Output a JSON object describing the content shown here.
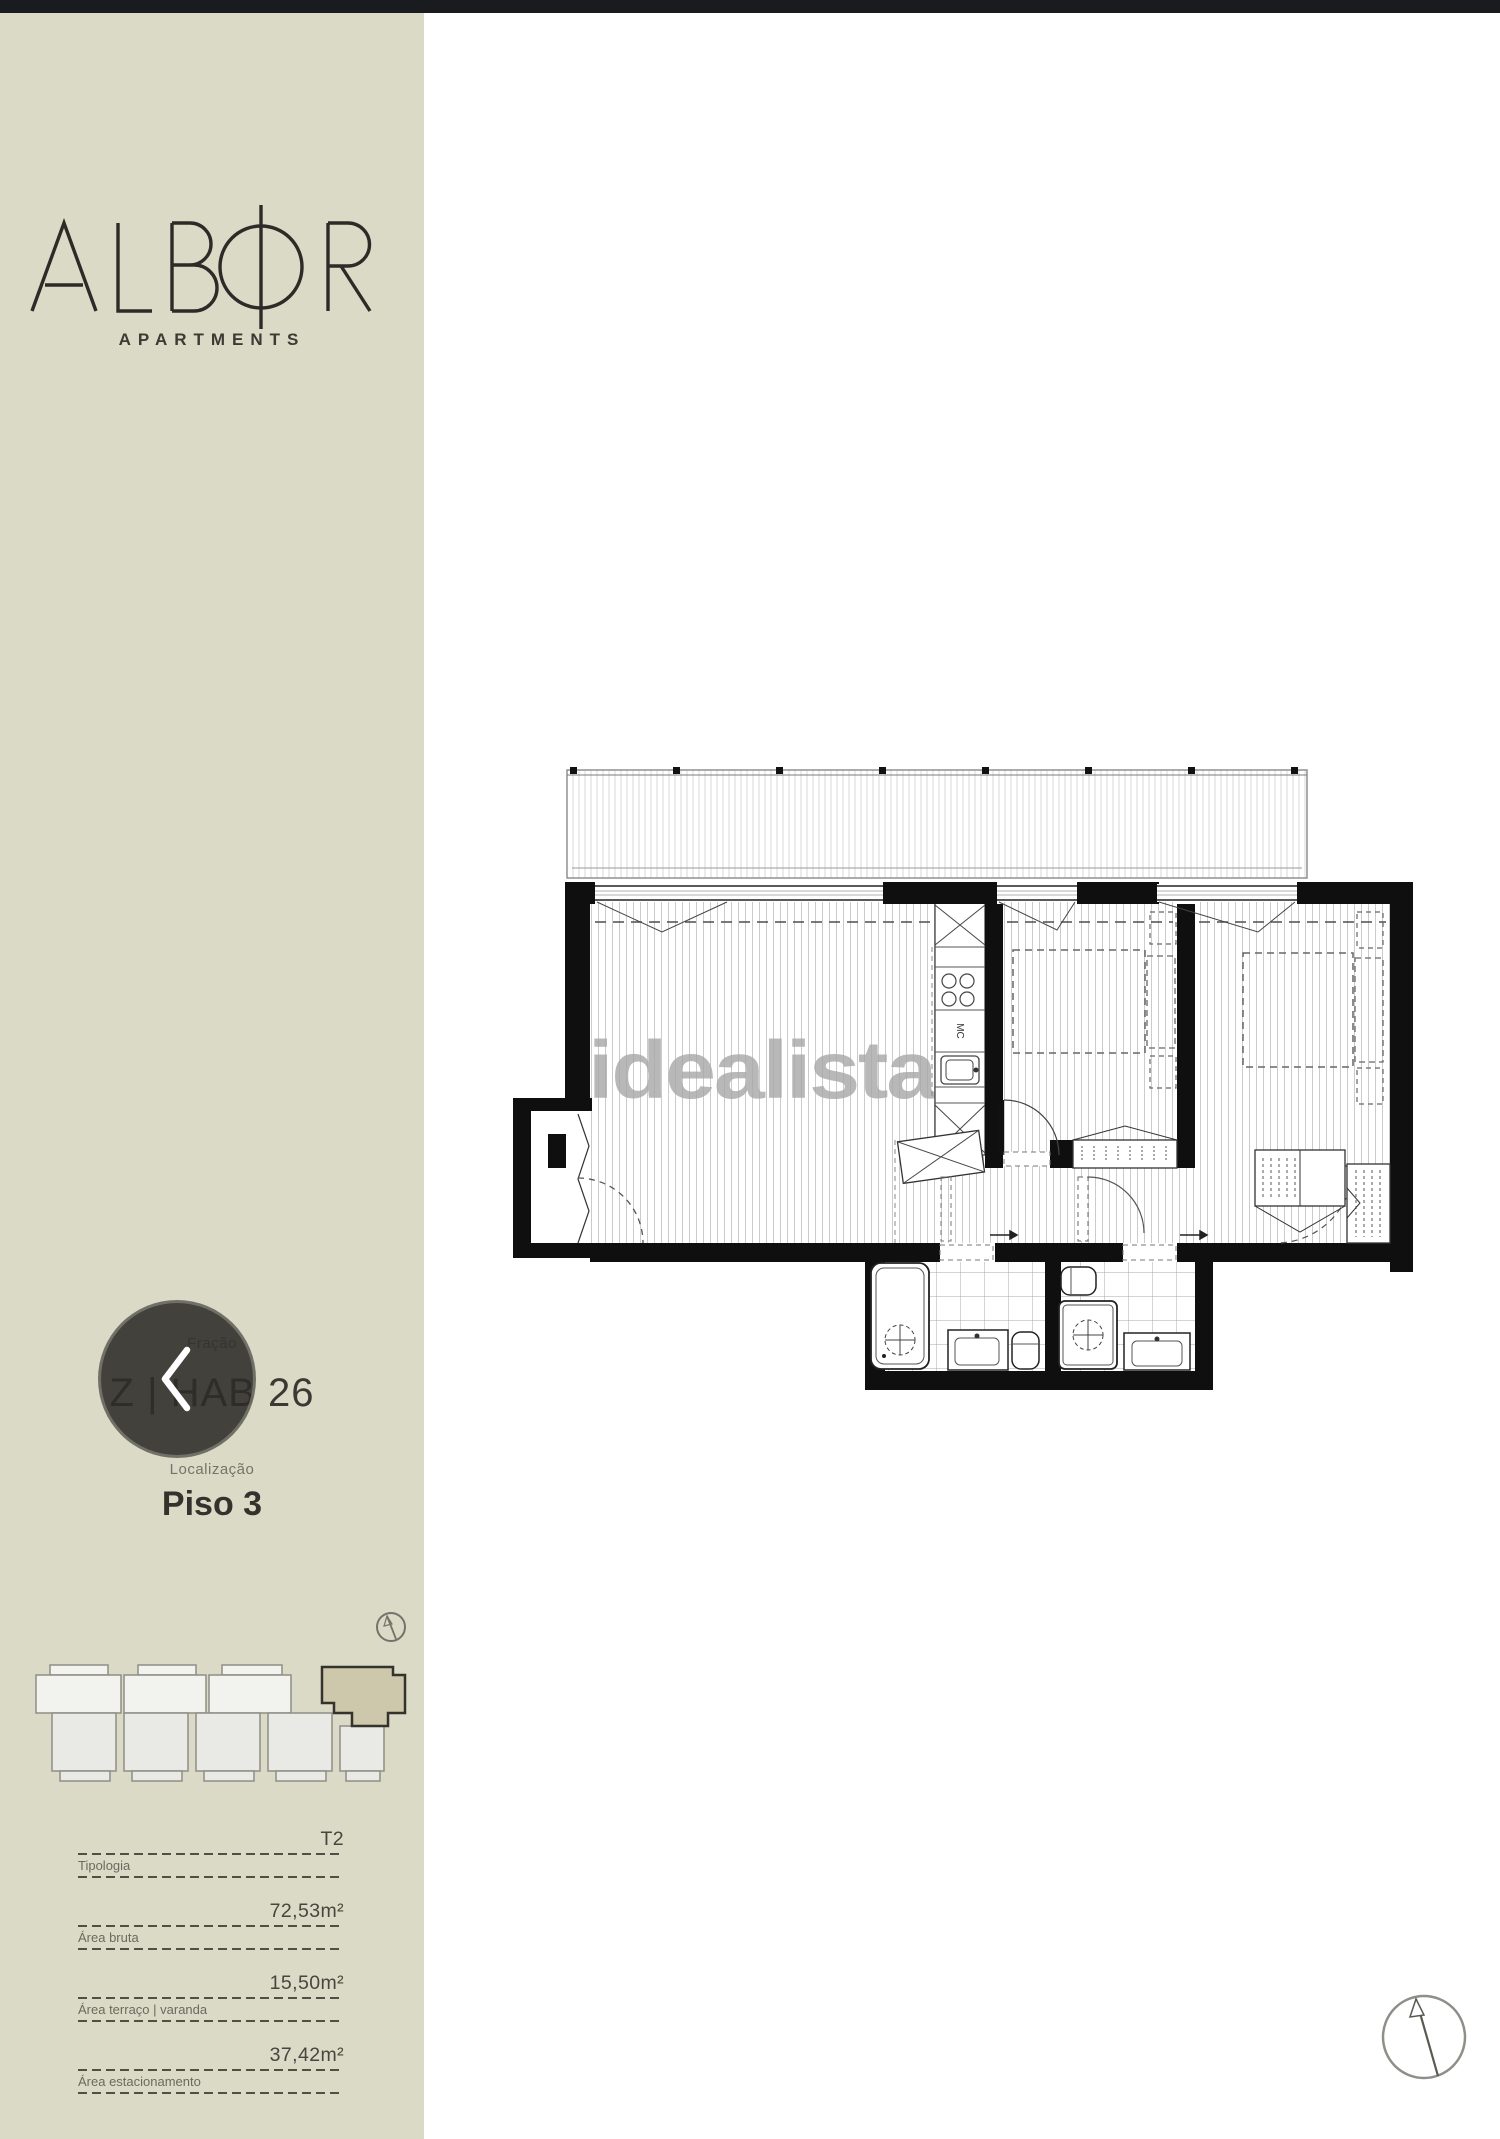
{
  "sidebar": {
    "background": "#dadac6",
    "brand": "ALBOR",
    "brand_subtitle": "APARTMENTS",
    "fraction_label": "Fração",
    "fraction_value": "Z | HAB 26",
    "location_label": "Localização",
    "location_value": "Piso 3",
    "specs": [
      {
        "label": "Tipologia",
        "value": "T2"
      },
      {
        "label": "Área bruta",
        "value": "72,53m²"
      },
      {
        "label": "Área terraço | varanda",
        "value": "15,50m²"
      },
      {
        "label": "Área estacionamento",
        "value": "37,42m²"
      }
    ],
    "highlight_color": "#cdc7ab"
  },
  "plan": {
    "watermark": "idealista",
    "microwave_label": "MC"
  }
}
